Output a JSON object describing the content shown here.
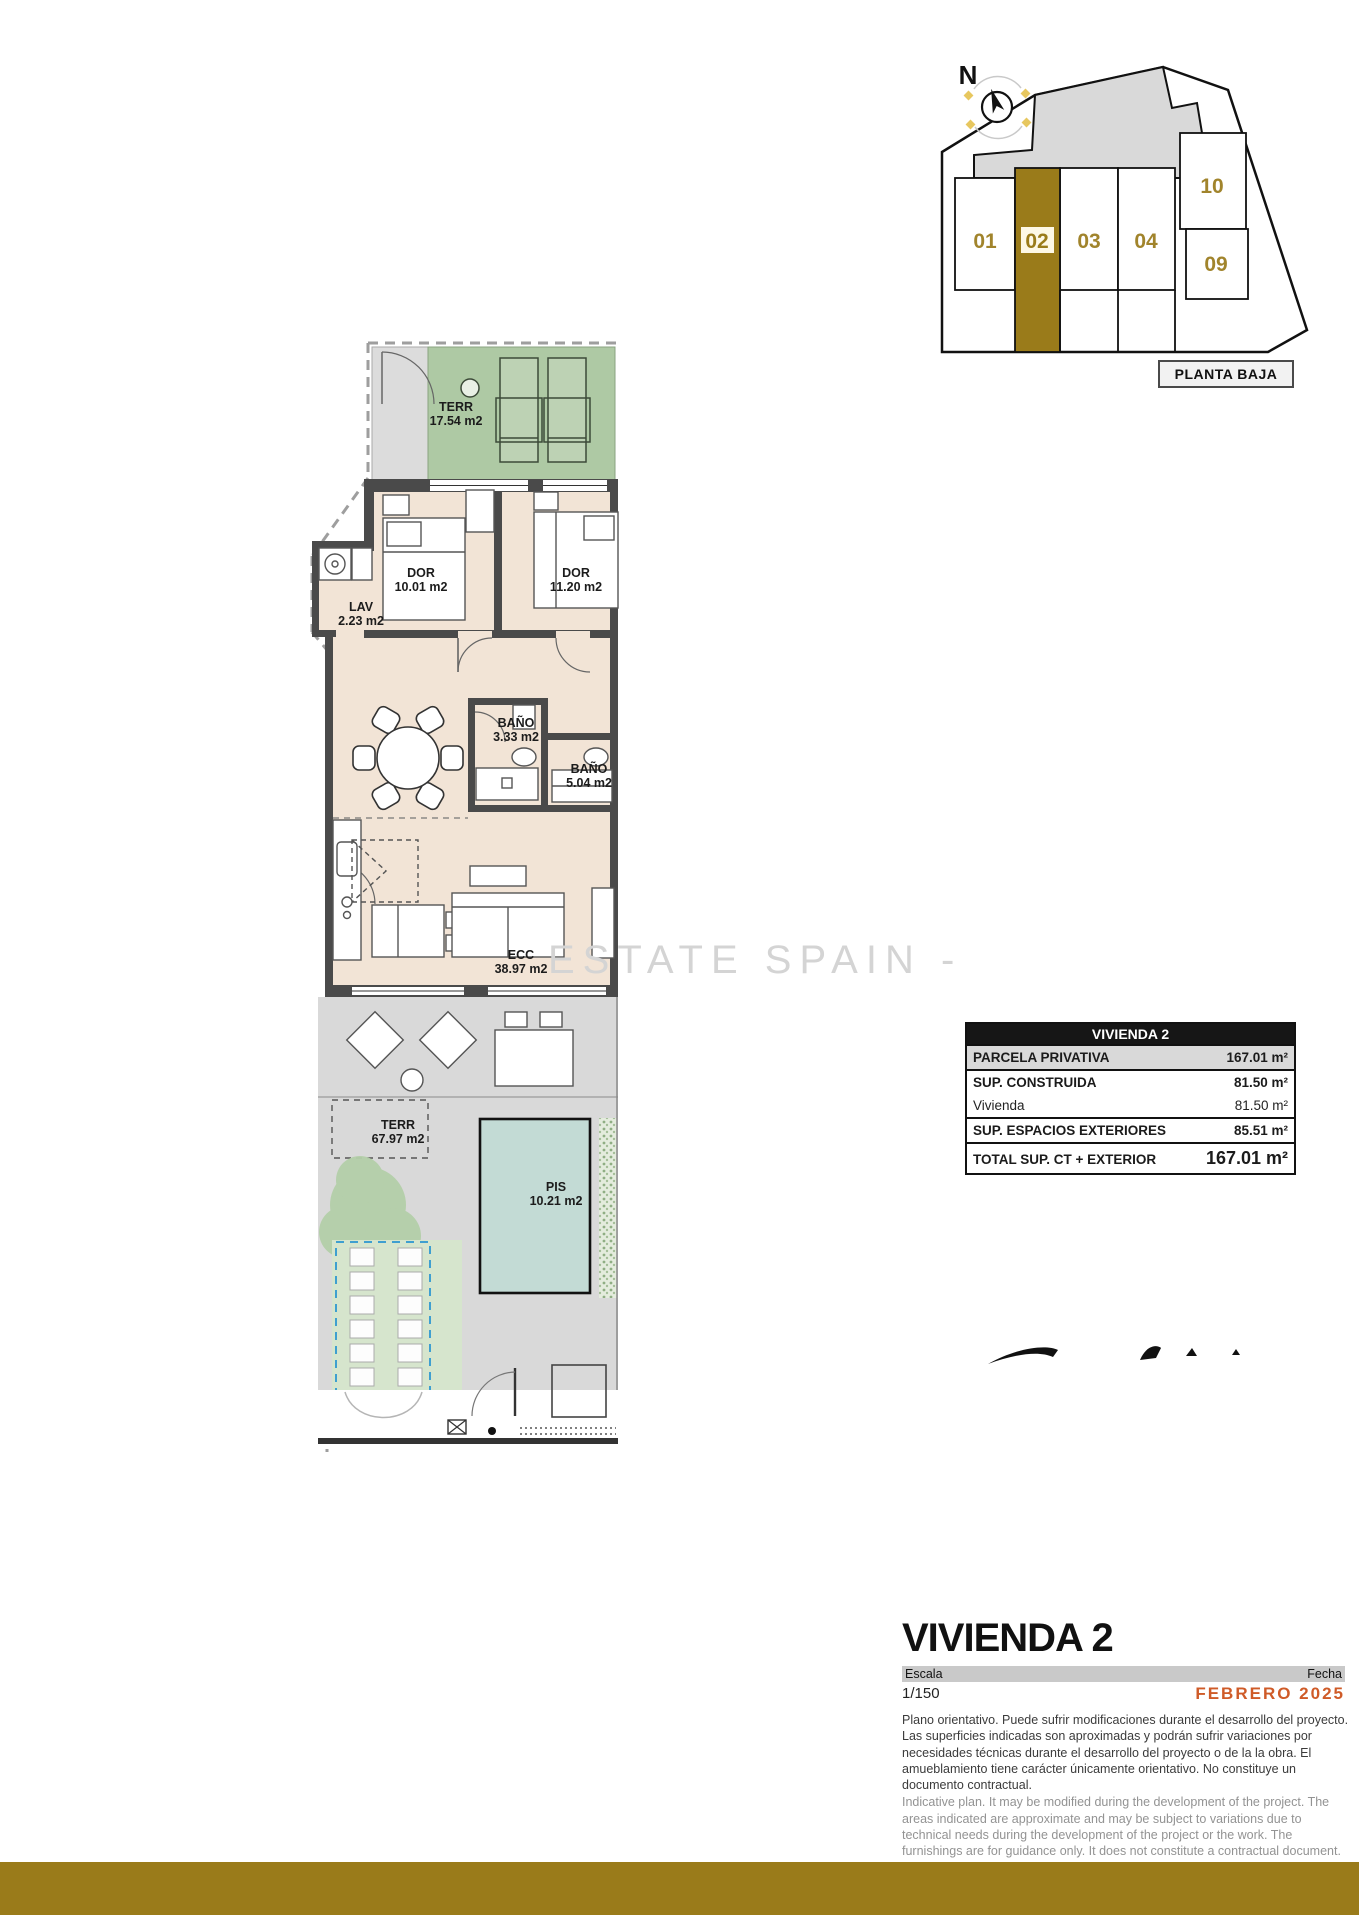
{
  "brand": {
    "gold": "#9a7b1a",
    "accent_orange": "#cf5b28"
  },
  "key_plan": {
    "compass_label": "N",
    "caption": "PLANTA BAJA",
    "highlighted_unit": "02",
    "units": [
      {
        "id": "01"
      },
      {
        "id": "02"
      },
      {
        "id": "03"
      },
      {
        "id": "04"
      },
      {
        "id": "09"
      },
      {
        "id": "10"
      }
    ]
  },
  "floor_plan": {
    "watermark": "ESTATE SPAIN -",
    "rooms": [
      {
        "key": "terraza-superior",
        "name": "TERR",
        "area": "17.54 m2"
      },
      {
        "key": "dormitorio-1",
        "name": "DOR",
        "area": "10.01 m2"
      },
      {
        "key": "dormitorio-2",
        "name": "DOR",
        "area": "11.20 m2"
      },
      {
        "key": "lavadero",
        "name": "LAV",
        "area": "2.23 m2"
      },
      {
        "key": "bano-1",
        "name": "BAÑO",
        "area": "3.33 m2"
      },
      {
        "key": "bano-2",
        "name": "BAÑO",
        "area": "5.04 m2"
      },
      {
        "key": "estar-comedor-cocina",
        "name": "ECC",
        "area": "38.97 m2"
      },
      {
        "key": "terraza-jardin",
        "name": "TERR",
        "area": "67.97 m2"
      },
      {
        "key": "piscina",
        "name": "PIS",
        "area": "10.21 m2"
      }
    ]
  },
  "summary_table": {
    "header": "VIVIENDA 2",
    "rows": [
      {
        "label": "PARCELA PRIVATIVA",
        "value": "167.01 m²"
      },
      {
        "label": "SUP. CONSTRUIDA",
        "value": "81.50 m²"
      },
      {
        "label": "Vivienda",
        "value": "81.50 m²"
      },
      {
        "label": "SUP. ESPACIOS EXTERIORES",
        "value": "85.51 m²"
      },
      {
        "label": "TOTAL SUP. CT + EXTERIOR",
        "value": "167.01 m²"
      }
    ]
  },
  "title_block": {
    "title": "VIVIENDA 2",
    "scale_label": "Escala",
    "scale_value": "1/150",
    "date_label": "Fecha",
    "date_value": "FEBRERO 2025",
    "disclaimer_es": "Plano orientativo. Puede sufrir modificaciones durante el desarrollo del proyecto. Las superficies indicadas son aproximadas y podrán sufrir variaciones por necesidades técnicas durante el desarrollo del proyecto o de la la obra. El amueblamiento tiene carácter únicamente orientativo. No constituye un documento contractual.",
    "disclaimer_en": "Indicative plan. It may be modified during the development of the project. The areas indicated are approximate and may be subject to variations due to technical needs during the development of the project or the work. The furnishings are for guidance only. It does not constitute a contractual document."
  }
}
